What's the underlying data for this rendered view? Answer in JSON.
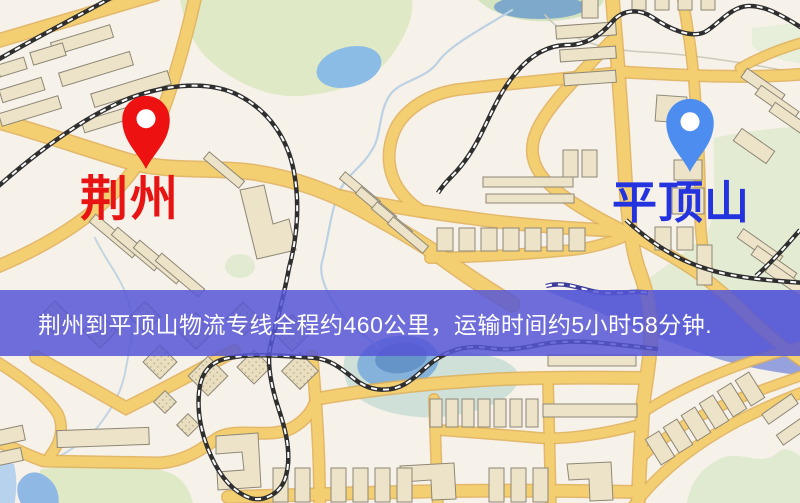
{
  "banner": {
    "text": "荆州到平顶山物流专线全程约460公里，运输时间约5小时58分钟.",
    "background_color": "#5656d6",
    "text_color": "#ffffff"
  },
  "markers": {
    "origin": {
      "label": "荆州",
      "pin_color": "#ee1111",
      "label_color": "#e81313"
    },
    "destination": {
      "label": "平顶山",
      "pin_color": "#4e8df0",
      "label_color": "#2433e0"
    }
  },
  "route": {
    "distance": "约460公里",
    "duration": "约5小时58分钟"
  },
  "map_palette": {
    "background": "#f6f1e9",
    "road": "#f3cf72",
    "road_casing": "#dfae55",
    "park": "#dfe9c6",
    "water": "#8abce6",
    "building": "#ece3c8",
    "railway": "#2f2f2f"
  }
}
